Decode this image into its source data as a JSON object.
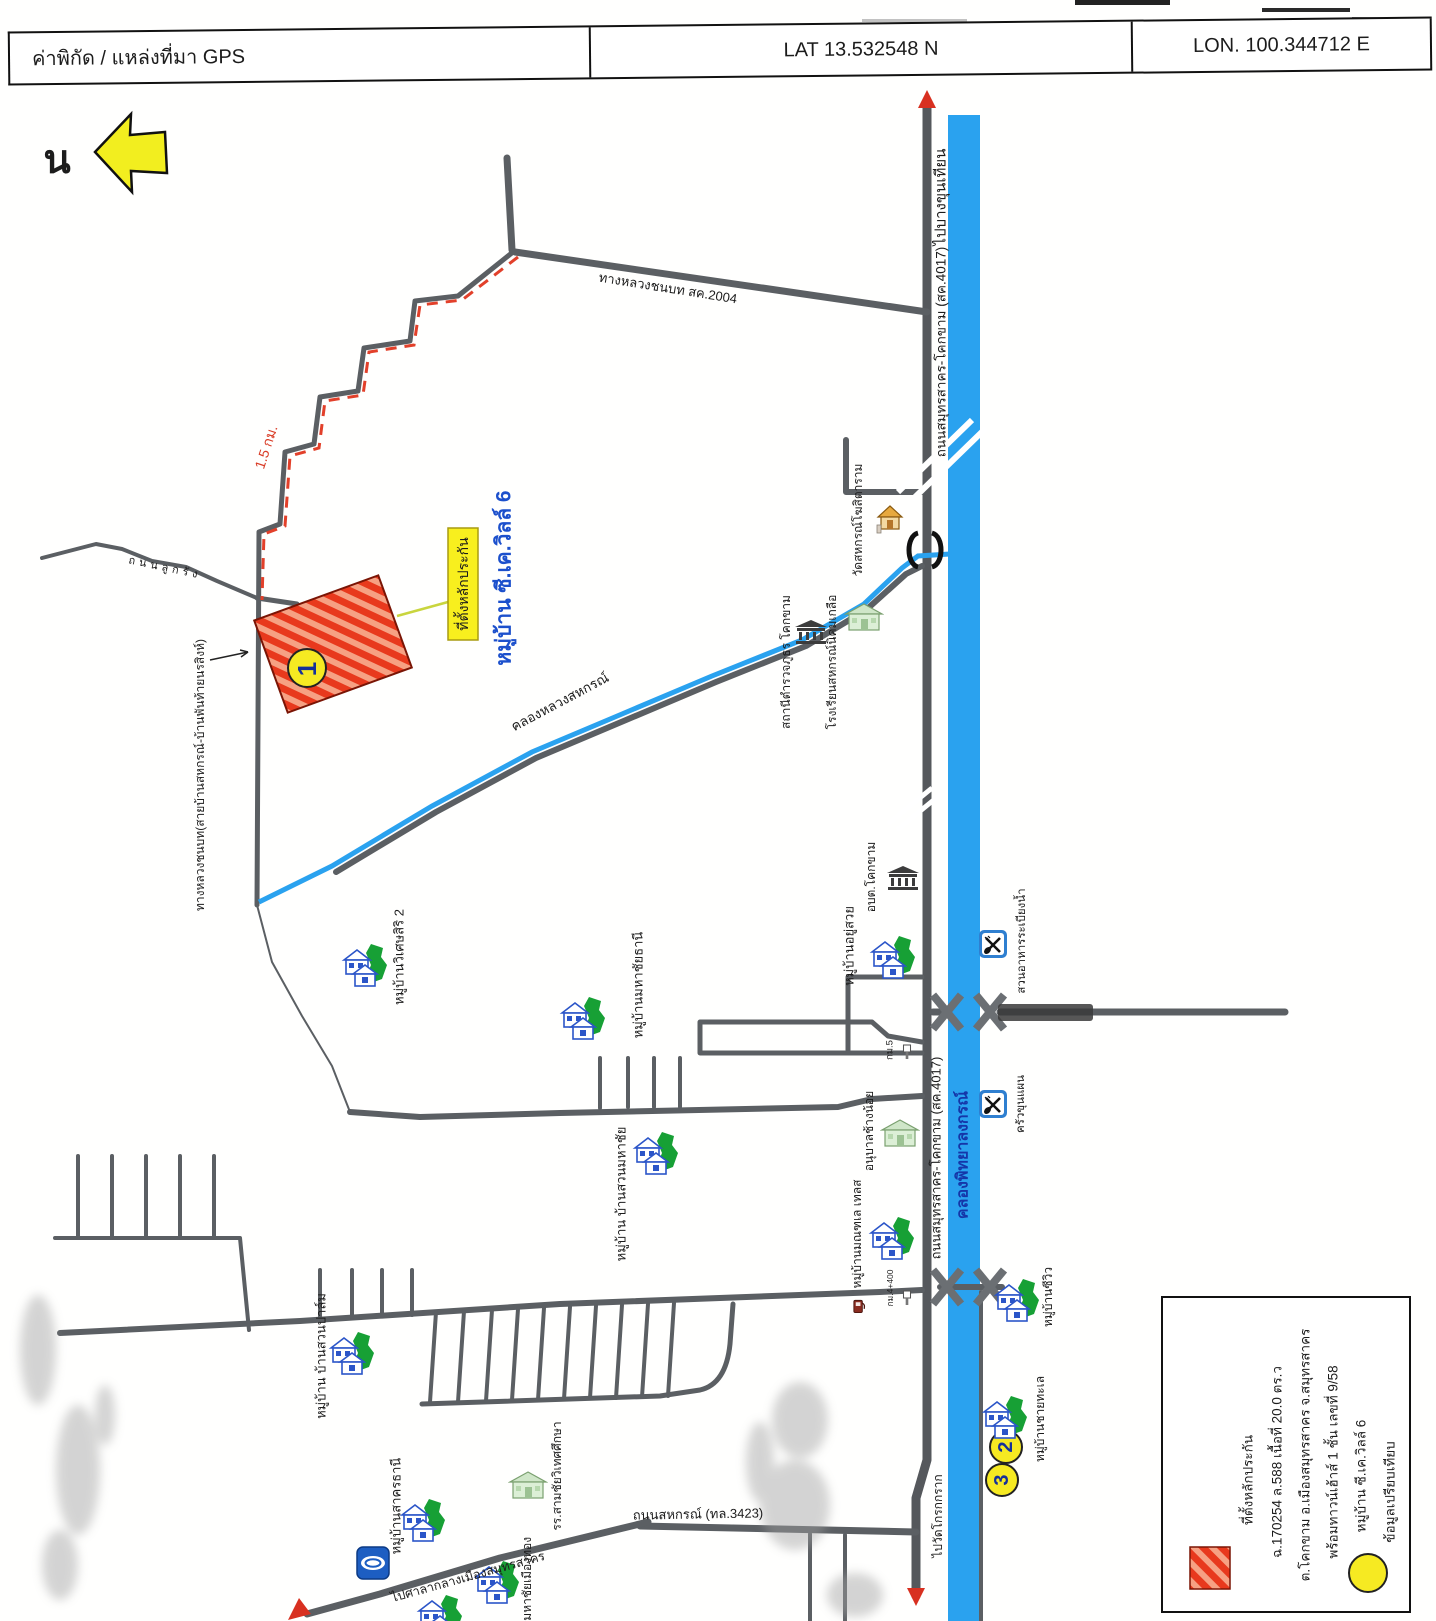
{
  "header": {
    "source": "ค่าพิกัด / แหล่งที่มา GPS",
    "lat": "LAT 13.532548  N",
    "lon": "LON.   100.344712  E"
  },
  "colors": {
    "canal_blue": "#2aa2ef",
    "road_gray": "#5b5f63",
    "parcel_red": "#e8391d",
    "marker_yellow": "#f6ea22",
    "tag_yellow": "#f8ef1e",
    "village_blue_text": "#1c50cc",
    "route_red": "#e2402a"
  },
  "map": {
    "labels": [
      {
        "name": "north-letter",
        "text": "น",
        "x": 57,
        "y": 160,
        "r": 0,
        "s": 40,
        "w": "bold"
      },
      {
        "name": "road-sc2004-label",
        "text": "ทางหลวงชนบท สค.2004",
        "x": 668,
        "y": 288,
        "r": 9,
        "s": 13
      },
      {
        "name": "to-bangkhunthian-label",
        "text": "ไปบางขุนเทียน",
        "x": 941,
        "y": 197,
        "r": -90,
        "s": 15
      },
      {
        "name": "road-4017-label-top",
        "text": "ถนนสมุทรสาคร-โคกขาม (สค.4017)",
        "x": 941,
        "y": 352,
        "r": -90,
        "s": 13.5
      },
      {
        "name": "road-4017-label-bottom",
        "text": "ถนนสมุทรสาคร-โคกขาม (สค.4017)",
        "x": 936,
        "y": 1158,
        "r": -90,
        "s": 13
      },
      {
        "name": "khlong-phitthayalongkon-label",
        "text": "คลองพิทยาลงกรณ์",
        "x": 963,
        "y": 1155,
        "r": -90,
        "s": 16,
        "c": "#1536a8",
        "w": "bold"
      },
      {
        "name": "route-distance-label",
        "text": "1.5 กม.",
        "x": 266,
        "y": 447,
        "r": -72,
        "s": 14,
        "c": "#d93b25"
      },
      {
        "name": "collateral-tag-label",
        "text": "ที่ตั้งหลักประกัน",
        "x": 463,
        "y": 584,
        "r": -90,
        "s": 14
      },
      {
        "name": "village-ckville-label",
        "text": "หมู่บ้าน ซี.เค.วิลล์ 6",
        "x": 504,
        "y": 578,
        "r": -90,
        "s": 21,
        "c": "#1c50cc",
        "w": "bold"
      },
      {
        "name": "rural-highway-label",
        "text": "ทางหลวงชนบท(สายบ้านสหกรณ์-บ้านพันท้ายนรสิงห์)",
        "x": 200,
        "y": 775,
        "r": -90,
        "s": 12
      },
      {
        "name": "gravel-road-label",
        "text": "ถนนลูกรัง",
        "x": 165,
        "y": 568,
        "r": 12,
        "s": 11,
        "ls": 4
      },
      {
        "name": "khlong-luang-sahakon-label",
        "text": "คลองหลวงสหกรณ์",
        "x": 560,
        "y": 702,
        "r": -28,
        "s": 13.5
      },
      {
        "name": "police-station-label",
        "text": "สถานีตำรวจภูธร โคกขาม",
        "x": 786,
        "y": 662,
        "r": -90,
        "s": 12
      },
      {
        "name": "school-sahakon-label",
        "text": "โรงเรียนสหกรณ์นิคมเกลือ",
        "x": 832,
        "y": 662,
        "r": -90,
        "s": 12
      },
      {
        "name": "wat-sahakon-label",
        "text": "วัดสหกรณ์โฆสิตาราม",
        "x": 858,
        "y": 520,
        "r": -90,
        "s": 12
      },
      {
        "name": "obt-khokkham-label",
        "text": "อบต.โคกขาม",
        "x": 871,
        "y": 877,
        "r": -90,
        "s": 12
      },
      {
        "name": "village-wisetsiri-label",
        "text": "หมู่บ้านวิเศษสิริ 2",
        "x": 399,
        "y": 957,
        "r": -90,
        "s": 13
      },
      {
        "name": "village-mahachaithani-label",
        "text": "หมู่บ้านมหาชัยธานี",
        "x": 638,
        "y": 985,
        "r": -90,
        "s": 13
      },
      {
        "name": "village-yusuai-label",
        "text": "หมู่บ้านอยู่สวย",
        "x": 849,
        "y": 946,
        "r": -90,
        "s": 13
      },
      {
        "name": "restaurant-rabiangnam-label",
        "text": "สวนอาหารระเบียงน้ำ",
        "x": 1022,
        "y": 941,
        "r": -90,
        "s": 11.5
      },
      {
        "name": "restaurant-khunphaen-label",
        "text": "ครัวขุนแผน",
        "x": 1021,
        "y": 1104,
        "r": -90,
        "s": 11.5
      },
      {
        "name": "km5-label",
        "text": "กม.5",
        "x": 890,
        "y": 1050,
        "r": -90,
        "s": 9.5
      },
      {
        "name": "anuban-changnoi-label",
        "text": "อนุบาลช้างน้อย",
        "x": 869,
        "y": 1131,
        "r": -90,
        "s": 12
      },
      {
        "name": "village-monthale-label",
        "text": "หมู่บ้านมณฑเล เทลส",
        "x": 857,
        "y": 1234,
        "r": -90,
        "s": 12
      },
      {
        "name": "km4400-label",
        "text": "กม.4+400",
        "x": 890,
        "y": 1288,
        "r": -90,
        "s": 8.5
      },
      {
        "name": "village-seaview-label",
        "text": "หมู่บ้านซีวิว",
        "x": 1048,
        "y": 1297,
        "r": -90,
        "s": 12
      },
      {
        "name": "village-chaithale-label",
        "text": "หมู่บ้านชายทะเล",
        "x": 1040,
        "y": 1419,
        "r": -90,
        "s": 12
      },
      {
        "name": "village-bansuanmahachai-label",
        "text": "หมู่บ้าน บ้านสวนมหาชัย",
        "x": 621,
        "y": 1194,
        "r": -90,
        "s": 13
      },
      {
        "name": "village-bansuanpalm-label",
        "text": "หมู่บ้าน บ้านสวนปาล์ม",
        "x": 321,
        "y": 1356,
        "r": -90,
        "s": 13
      },
      {
        "name": "village-sakhonthani-label",
        "text": "หมู่บ้านสาครธานี",
        "x": 396,
        "y": 1506,
        "r": -90,
        "s": 13
      },
      {
        "name": "samchai-school-label",
        "text": "รร.สามชัยวิเทศศึกษา",
        "x": 557,
        "y": 1476,
        "r": -90,
        "s": 12
      },
      {
        "name": "village-mueangthong-label",
        "text": "หมู่บ้านมหาชัยเมืองทอง",
        "x": 527,
        "y": 1598,
        "r": -90,
        "s": 12
      },
      {
        "name": "to-city-hall-label",
        "text": "ไปศาลากลางเมืองสมุทรสาคร",
        "x": 468,
        "y": 1577,
        "r": -15.5,
        "s": 12.5
      },
      {
        "name": "sahakon-road-label",
        "text": "ถนนสหกรณ์ (ทล.3423)",
        "x": 698,
        "y": 1514,
        "r": -1,
        "s": 13
      },
      {
        "name": "to-wat-krokkrak-label",
        "text": "ไปวัดโกรกกราก",
        "x": 938,
        "y": 1516,
        "r": -90,
        "s": 12
      },
      {
        "name": "parcel-number",
        "text": "1",
        "x": 307,
        "y": 669,
        "r": -90,
        "s": 26,
        "w": "bold",
        "c": "#15309a"
      },
      {
        "name": "comparable-2-number",
        "text": "2",
        "x": 1006,
        "y": 1447,
        "r": -90,
        "s": 20,
        "w": "bold",
        "c": "#15309a"
      },
      {
        "name": "comparable-3-number",
        "text": "3",
        "x": 1002,
        "y": 1480,
        "r": -90,
        "s": 20,
        "w": "bold",
        "c": "#15309a"
      },
      {
        "name": "legend-line1",
        "text": "ที่ตั้งหลักประกัน",
        "x": 1248,
        "y": 1480,
        "r": -90,
        "s": 13.5
      },
      {
        "name": "legend-line2",
        "text": "ฉ.170254 ล.588 เนื้อที่ 20.0 ตร.ว",
        "x": 1277,
        "y": 1462,
        "r": -90,
        "s": 13.5
      },
      {
        "name": "legend-line3",
        "text": "ต.โคกขาม อ.เมืองสมุทรสาคร จ.สมุทรสาคร",
        "x": 1305,
        "y": 1455,
        "r": -90,
        "s": 13.5
      },
      {
        "name": "legend-line4",
        "text": "พร้อมทาวน์เฮ้าส์ 1 ชั้น เลขที่ 9/58",
        "x": 1333,
        "y": 1462,
        "r": -90,
        "s": 13.5
      },
      {
        "name": "legend-line5",
        "text": "หมู่บ้าน ซี.เค.วิลล์ 6",
        "x": 1361,
        "y": 1476,
        "r": -90,
        "s": 13.5
      },
      {
        "name": "legend-line6",
        "text": "ข้อมูลเปรียบเทียบ",
        "x": 1390,
        "y": 1492,
        "r": -90,
        "s": 13.5
      }
    ]
  }
}
